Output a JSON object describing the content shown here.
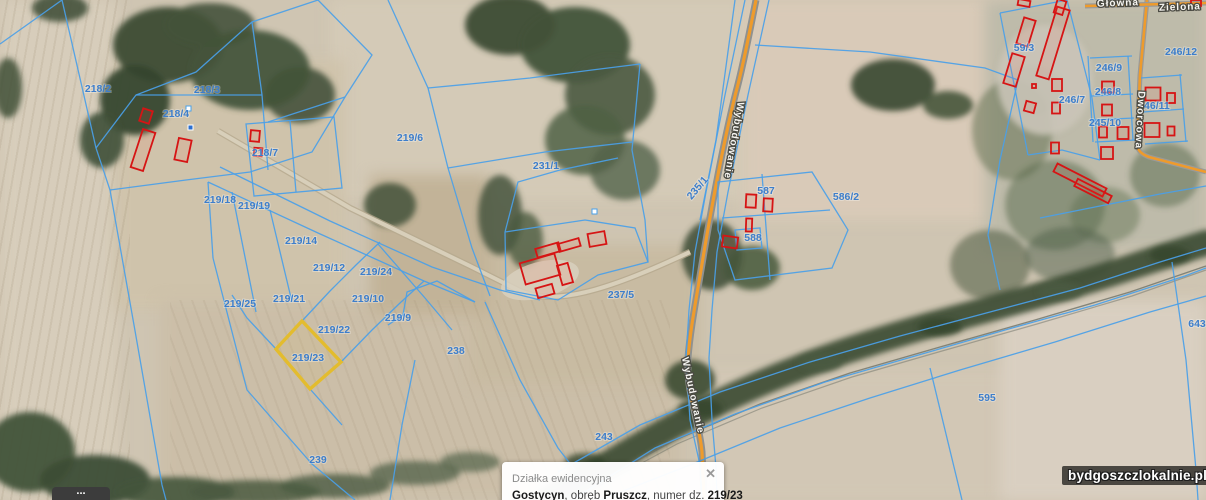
{
  "map": {
    "selected_parcel": "219/23",
    "colors": {
      "parcel_line": "#4aa0e8",
      "parcel_label": "#3d7ecb",
      "building_outline": "#d61414",
      "selected_parcel_outline": "#e3bc2e",
      "road_orange": "#ee9b2c"
    },
    "parcel_labels": [
      {
        "text": "218/2",
        "x": 98,
        "y": 92
      },
      {
        "text": "218/3",
        "x": 207,
        "y": 93
      },
      {
        "text": "218/4",
        "x": 176,
        "y": 117
      },
      {
        "text": "218/7",
        "x": 265,
        "y": 156
      },
      {
        "text": "219/6",
        "x": 410,
        "y": 141
      },
      {
        "text": "219/18",
        "x": 220,
        "y": 203
      },
      {
        "text": "219/19",
        "x": 254,
        "y": 209
      },
      {
        "text": "219/14",
        "x": 301,
        "y": 244
      },
      {
        "text": "219/12",
        "x": 329,
        "y": 271
      },
      {
        "text": "219/24",
        "x": 376,
        "y": 275
      },
      {
        "text": "219/10",
        "x": 368,
        "y": 302
      },
      {
        "text": "219/21",
        "x": 289,
        "y": 302
      },
      {
        "text": "219/25",
        "x": 240,
        "y": 307
      },
      {
        "text": "219/9",
        "x": 398,
        "y": 321
      },
      {
        "text": "219/22",
        "x": 334,
        "y": 333
      },
      {
        "text": "219/23",
        "x": 308,
        "y": 361
      },
      {
        "text": "238",
        "x": 456,
        "y": 354
      },
      {
        "text": "239",
        "x": 318,
        "y": 463
      },
      {
        "text": "243",
        "x": 604,
        "y": 440
      },
      {
        "text": "231/1",
        "x": 546,
        "y": 169
      },
      {
        "text": "235/1",
        "x": 700,
        "y": 190,
        "rot": -50
      },
      {
        "text": "237/5",
        "x": 621,
        "y": 298
      },
      {
        "text": "586/2",
        "x": 846,
        "y": 200
      },
      {
        "text": "587",
        "x": 766,
        "y": 194
      },
      {
        "text": "588",
        "x": 753,
        "y": 241
      },
      {
        "text": "59/3",
        "x": 1024,
        "y": 51
      },
      {
        "text": "246/7",
        "x": 1072,
        "y": 103
      },
      {
        "text": "246/9",
        "x": 1109,
        "y": 71
      },
      {
        "text": "246/8",
        "x": 1108,
        "y": 95
      },
      {
        "text": "245/10",
        "x": 1105,
        "y": 126
      },
      {
        "text": "246/11",
        "x": 1154,
        "y": 109
      },
      {
        "text": "246/12",
        "x": 1181,
        "y": 55
      },
      {
        "text": "643",
        "x": 1197,
        "y": 327
      },
      {
        "text": "595",
        "x": 987,
        "y": 401
      }
    ],
    "street_labels": [
      {
        "text": "Wybudowanie",
        "x": 731,
        "y": 140,
        "rot": 100
      },
      {
        "text": "Wybudowanie",
        "x": 690,
        "y": 396,
        "rot": 78
      },
      {
        "text": "Dworcowa",
        "x": 1137,
        "y": 120,
        "rot": 93
      },
      {
        "text": "Zielona",
        "x": 1180,
        "y": 10,
        "rot": -2
      },
      {
        "text": "Główna",
        "x": 1118,
        "y": 6,
        "rot": -2
      }
    ]
  },
  "popup": {
    "title": "Działka ewidencyjna",
    "close_glyph": "✕",
    "municipality": "Gostycyn",
    "sep1": ", obręb ",
    "district": "Pruszcz",
    "sep2": ", numer dz. ",
    "parcel_number": "219/23",
    "clipped_text": "241999, 0 0005 049/99"
  },
  "watermark": {
    "text": "bydgoszczlokalnie.pl"
  },
  "controls": {
    "partial_dots": "..."
  }
}
